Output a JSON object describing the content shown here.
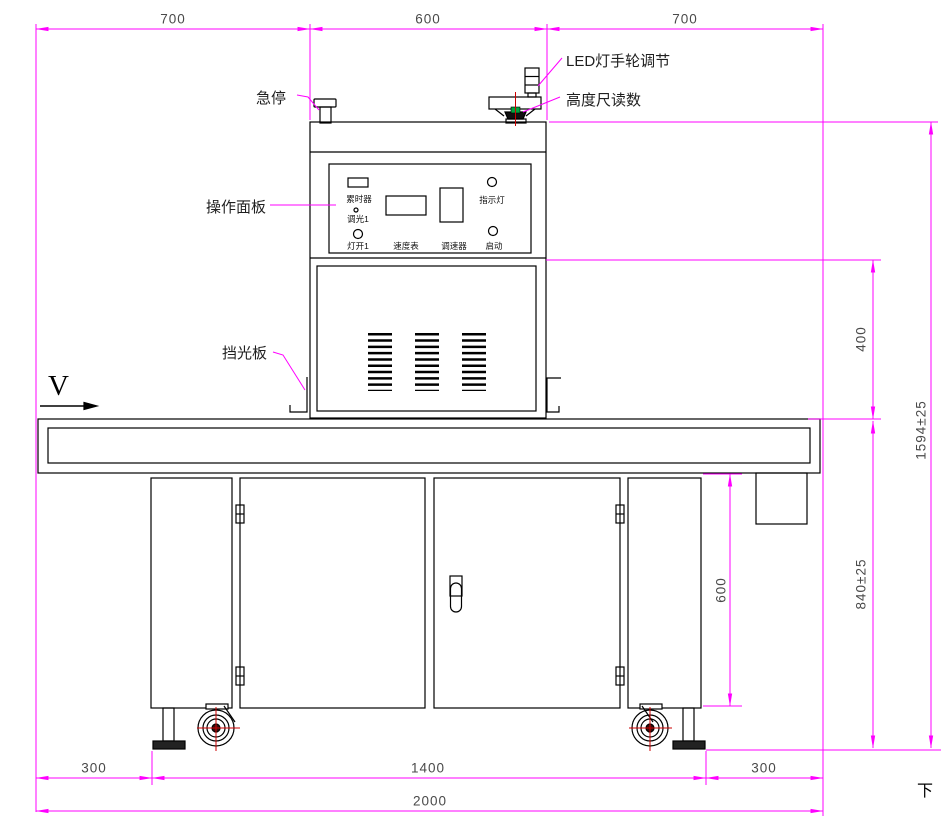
{
  "labels": {
    "view_direction": "V",
    "sheet_mark": "下",
    "emergency_stop": "急停",
    "led_handwheel": "LED灯手轮调节",
    "height_gauge": "高度尺读数",
    "operation_panel": "操作面板",
    "light_shield": "挡光板"
  },
  "panel": {
    "timer": "累时器",
    "dimmer1": "调光1",
    "lamp_on1": "灯开1",
    "speedometer": "速度表",
    "speed_controller": "调速器",
    "indicator": "指示灯",
    "start": "启动"
  },
  "dimensions": {
    "top": [
      "700",
      "600",
      "700"
    ],
    "bottom": [
      "300",
      "1400",
      "300"
    ],
    "bottom_total": "2000",
    "right_upper": "400",
    "right_total": "1594±25",
    "right_lower": "840±25",
    "cabinet_height": "600"
  },
  "colors": {
    "dimension_line": "#ff00ff",
    "centerline": "#cc0000",
    "outline": "#000000",
    "gauge_marker": "#00a33c",
    "dimension_text": "#4a4a4a"
  }
}
